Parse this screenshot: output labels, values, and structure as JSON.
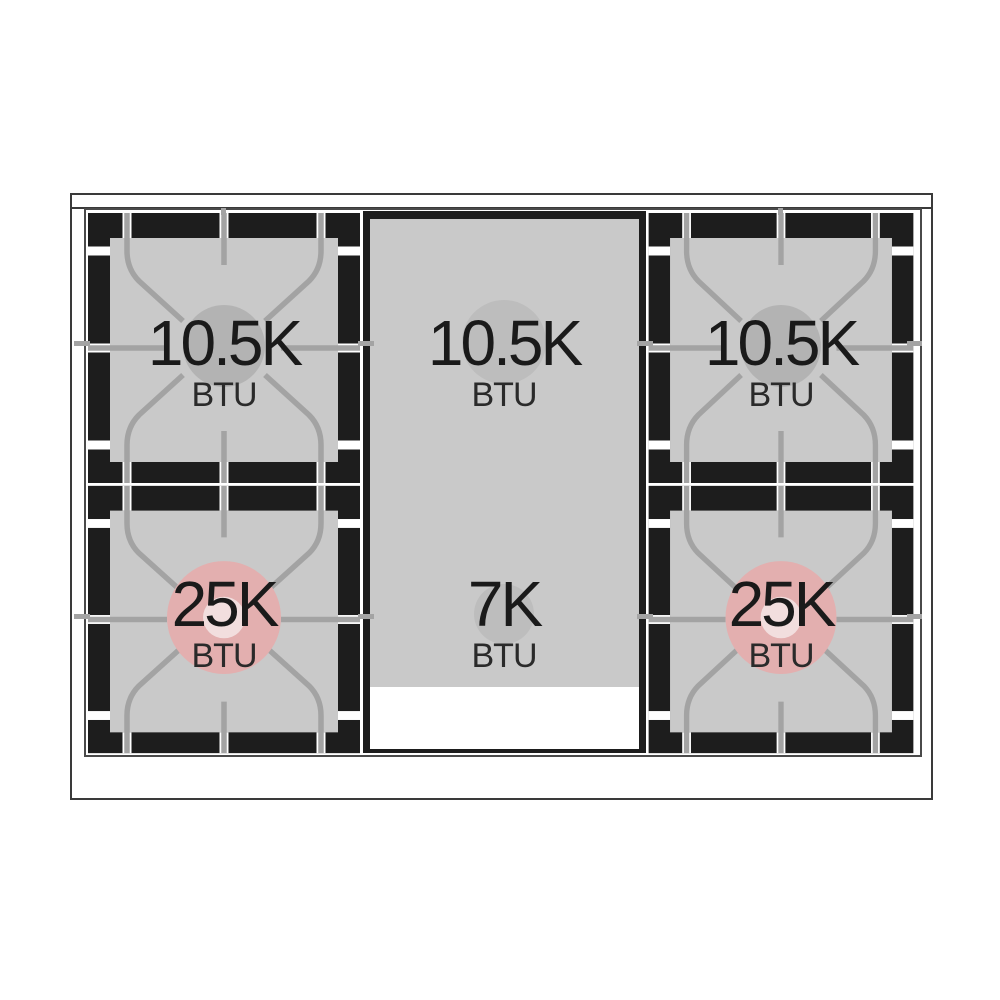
{
  "figure_type": "range-cooktop-burner-btu-diagram",
  "burners": [
    {
      "id": "top-left",
      "power": "10.5K",
      "unit": "BTU"
    },
    {
      "id": "center-rear",
      "power": "10.5K",
      "unit": "BTU"
    },
    {
      "id": "top-right",
      "power": "10.5K",
      "unit": "BTU"
    },
    {
      "id": "bottom-left",
      "power": "25K",
      "unit": "BTU"
    },
    {
      "id": "center-front",
      "power": "7K",
      "unit": "BTU"
    },
    {
      "id": "bottom-right",
      "power": "25K",
      "unit": "BTU"
    }
  ],
  "colors": {
    "grate_black": "#1d1d1d",
    "surface_gray": "#c9c9c9",
    "burner_circle_gray": "#b3b3b3",
    "burner_circle_pink": "#e3afaf",
    "burner_circle_pink_center": "#f2dede",
    "grate_line_gray": "#a3a3a3",
    "outline_dark": "#3a3a3a",
    "label_text": "#1a1a1a",
    "griddle_circle_gray": "#bdbdbd"
  }
}
